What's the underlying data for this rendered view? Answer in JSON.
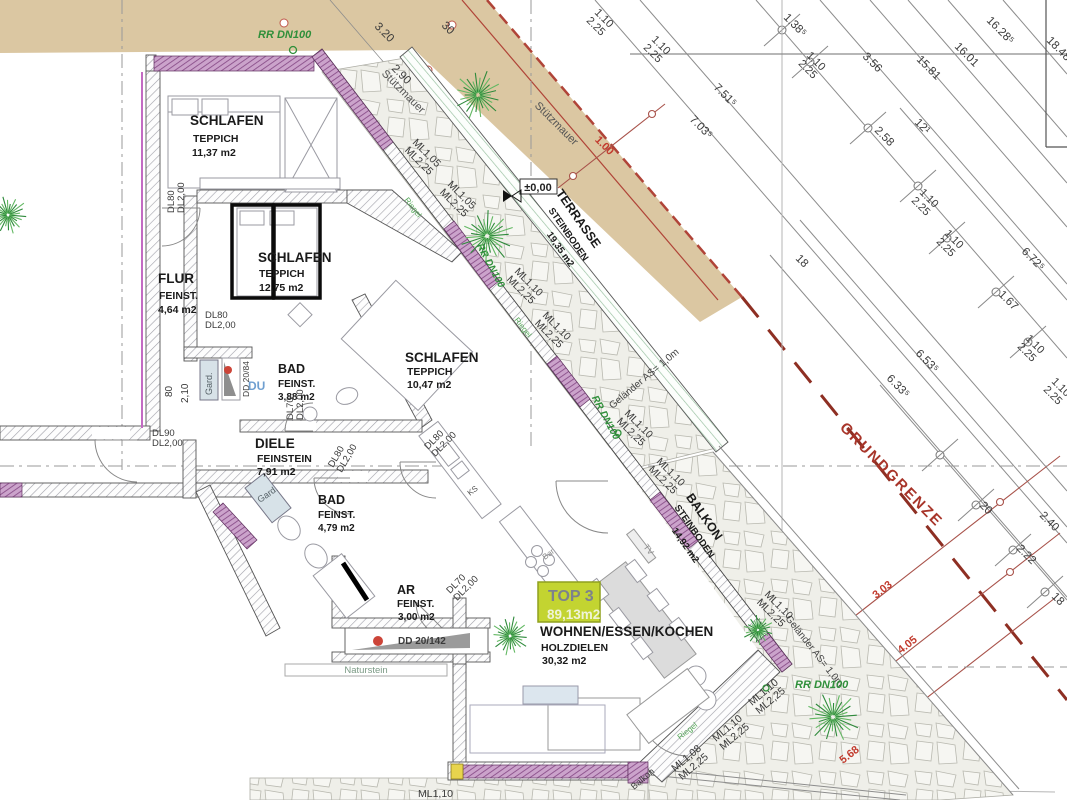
{
  "unit": {
    "name": "TOP 3",
    "area": "89,13m2"
  },
  "rooms": [
    {
      "name": "SCHLAFEN",
      "floor": "TEPPICH",
      "area": "11,37 m2"
    },
    {
      "name": "SCHLAFEN",
      "floor": "TEPPICH",
      "area": "12,75 m2"
    },
    {
      "name": "FLUR",
      "floor": "FEINST.",
      "area": "4,64 m2"
    },
    {
      "name": "BAD",
      "floor": "FEINST.",
      "area": "3,88 m2"
    },
    {
      "name": "DIELE",
      "floor": "FEINSTEIN",
      "area": "7,91 m2"
    },
    {
      "name": "BAD",
      "floor": "FEINST.",
      "area": "4,79 m2"
    },
    {
      "name": "AR",
      "floor": "FEINST.",
      "area": "3,00 m2"
    },
    {
      "name": "SCHLAFEN",
      "floor": "TEPPICH",
      "area": "10,47 m2"
    },
    {
      "name": "TERRASSE",
      "floor": "STEINBODEN",
      "area": "19,35 m2"
    },
    {
      "name": "BALKON",
      "floor": "STEINBODEN",
      "area": "14,92 m2"
    },
    {
      "name": "WOHNEN/ESSEN/KOCHEN",
      "floor": "HOLZDIELEN",
      "area": "30,32 m2"
    }
  ],
  "site": {
    "boundary_label": "GRUNDGRENZE",
    "retaining_wall_label": "Stützmauer",
    "railing_label": "Geländer AS= 1,0m",
    "level_label": "±0,00",
    "path_label": "Naturstein",
    "drain_label": "RR DN100",
    "offset_dim": "1.00"
  },
  "colors": {
    "dim": "#3a3a3a",
    "red": "#c23b2e",
    "boundary": "#a8352a",
    "green": "#2f8f3a",
    "green2": "#58a85c",
    "blue": "#6f9fd0",
    "gray": "#8a8a8a",
    "muted": "#555555",
    "cab": "#556066",
    "natur": "#7b9a85",
    "tan": "#dbc7a2",
    "purple": "#cba3cb",
    "top3_box": "#c3d431"
  },
  "annotations": [
    {
      "t": "3.20",
      "x": 374,
      "y": 27,
      "r": 45,
      "s": 11.5
    },
    {
      "t": "30",
      "x": 441,
      "y": 26,
      "r": 45,
      "s": 11.5
    },
    {
      "t": "2.90",
      "x": 391,
      "y": 69,
      "r": 45,
      "s": 11.5
    },
    {
      "t": "1.38⁵",
      "x": 783,
      "y": 18,
      "r": 45,
      "s": 11.5
    },
    {
      "t": "3.56",
      "x": 862,
      "y": 57,
      "r": 45,
      "s": 11.5
    },
    {
      "t": "15.81",
      "x": 916,
      "y": 60,
      "r": 45,
      "s": 11.5
    },
    {
      "t": "16.01",
      "x": 954,
      "y": 47,
      "r": 45,
      "s": 11.5
    },
    {
      "t": "16.28⁵",
      "x": 986,
      "y": 21,
      "r": 45,
      "s": 11.5
    },
    {
      "t": "18.48⁵",
      "x": 1046,
      "y": 41,
      "r": 45,
      "s": 11.5
    },
    {
      "t": "7.51⁵",
      "x": 713,
      "y": 88,
      "r": 45,
      "s": 11.5
    },
    {
      "t": "7.03⁵",
      "x": 689,
      "y": 120,
      "r": 45,
      "s": 11.5
    },
    {
      "t": "6.72⁵",
      "x": 1021,
      "y": 252,
      "r": 45,
      "s": 11.5
    },
    {
      "t": "6.53⁵",
      "x": 915,
      "y": 354,
      "r": 45,
      "s": 11.5
    },
    {
      "t": "6.33⁵",
      "x": 886,
      "y": 379,
      "r": 45,
      "s": 11.5
    },
    {
      "t": "2.58",
      "x": 874,
      "y": 131,
      "r": 45,
      "s": 11.5
    },
    {
      "t": "12¹",
      "x": 914,
      "y": 123,
      "r": 45,
      "s": 11.5
    },
    {
      "t": "1.67",
      "x": 998,
      "y": 295,
      "r": 45,
      "s": 11.5
    },
    {
      "t": "2.40",
      "x": 1039,
      "y": 516,
      "r": 45,
      "s": 11.5
    },
    {
      "t": "2.22",
      "x": 1016,
      "y": 549,
      "r": 45,
      "s": 11.5
    },
    {
      "t": "18",
      "x": 1051,
      "y": 597,
      "r": 45,
      "s": 11.5
    },
    {
      "t": "18",
      "x": 795,
      "y": 259,
      "r": 45,
      "s": 11.5
    },
    {
      "t": "20",
      "x": 979,
      "y": 506,
      "r": 45,
      "s": 11.5
    },
    {
      "t": "1.10",
      "t2": "2.25",
      "x": 806,
      "y": 56,
      "r": 45,
      "s": 11
    },
    {
      "t": "1.10",
      "t2": "2.25",
      "x": 919,
      "y": 193,
      "r": 45,
      "s": 11
    },
    {
      "t": "1.10",
      "t2": "2.25",
      "x": 944,
      "y": 234,
      "r": 45,
      "s": 11
    },
    {
      "t": "1.10",
      "t2": "2.25",
      "x": 1025,
      "y": 339,
      "r": 45,
      "s": 11
    },
    {
      "t": "1.10",
      "t2": "2.25",
      "x": 1051,
      "y": 382,
      "r": 45,
      "s": 11
    },
    {
      "t": "1.10",
      "t2": "2.25",
      "x": 594,
      "y": 13,
      "r": 45,
      "s": 11
    },
    {
      "t": "1.10",
      "t2": "2.25",
      "x": 651,
      "y": 40,
      "r": 45,
      "s": 11
    },
    {
      "t": "3.03",
      "x": 876,
      "y": 599,
      "r": -38,
      "s": 11,
      "c": "red",
      "w": "bold"
    },
    {
      "t": "4.05",
      "x": 901,
      "y": 654,
      "r": -38,
      "s": 11,
      "c": "red",
      "w": "bold"
    },
    {
      "t": "5.68",
      "x": 843,
      "y": 764,
      "r": -38,
      "s": 11,
      "c": "red",
      "w": "bold"
    },
    {
      "t": "ML1,05",
      "t2": "ML2,25",
      "x": 412,
      "y": 143,
      "r": 45,
      "s": 10.5
    },
    {
      "t": "ML1,05",
      "t2": "ML2,25",
      "x": 447,
      "y": 185,
      "r": 45,
      "s": 10.5
    },
    {
      "t": "ML1,10",
      "t2": "ML2,25",
      "x": 514,
      "y": 272,
      "r": 45,
      "s": 10.5
    },
    {
      "t": "ML1,10",
      "t2": "ML2,25",
      "x": 542,
      "y": 316,
      "r": 45,
      "s": 10.5
    },
    {
      "t": "ML1,10",
      "t2": "ML2,25",
      "x": 624,
      "y": 414,
      "r": 45,
      "s": 10.5
    },
    {
      "t": "ML1,10",
      "t2": "ML2,25",
      "x": 656,
      "y": 462,
      "r": 45,
      "s": 10.5
    },
    {
      "t": "ML1,10",
      "t2": "ML2,25",
      "x": 764,
      "y": 595,
      "r": 45,
      "s": 10.5
    },
    {
      "t": "ML1,10",
      "t2": "ML2,25",
      "x": 752,
      "y": 706,
      "r": -40,
      "s": 10.5
    },
    {
      "t": "ML1,10",
      "t2": "ML2,25",
      "x": 716,
      "y": 742,
      "r": -40,
      "s": 10.5
    },
    {
      "t": "ML1,08",
      "t2": "ML2,25",
      "x": 675,
      "y": 772,
      "r": -40,
      "s": 10.5
    },
    {
      "t": "ML1,10",
      "x": 418,
      "y": 797,
      "r": 0,
      "s": 10.5
    },
    {
      "t": "DL80",
      "t2": "DL2,00",
      "x": 174,
      "y": 213,
      "r": -90,
      "s": 9.5
    },
    {
      "t": "DL80",
      "t2": "DL2,00",
      "x": 205,
      "y": 318,
      "r": 0,
      "s": 9.5
    },
    {
      "t": "DL90",
      "t2": "DL2,00",
      "x": 152,
      "y": 436,
      "r": 0,
      "s": 9.5
    },
    {
      "t": "DL70",
      "t2": "DL2,00",
      "x": 293,
      "y": 420,
      "r": -90,
      "s": 9.5
    },
    {
      "t": "DL80",
      "t2": "DL2,00",
      "x": 333,
      "y": 468,
      "r": -60,
      "s": 9.5
    },
    {
      "t": "DL80",
      "t2": "DL2,00",
      "x": 428,
      "y": 450,
      "r": -45,
      "s": 9.5
    },
    {
      "t": "DL70",
      "t2": "DL2,00",
      "x": 450,
      "y": 594,
      "r": -45,
      "s": 9.5
    },
    {
      "t": "DD 20/84",
      "x": 249,
      "y": 397,
      "r": -90,
      "s": 8.5
    },
    {
      "t": "DD 20/142",
      "x": 398,
      "y": 644,
      "r": 0,
      "s": 10,
      "w": "bold"
    },
    {
      "t": "DU",
      "x": 248,
      "y": 390,
      "r": 0,
      "s": 12,
      "c": "blue",
      "w": "bold"
    },
    {
      "t": "Gard.",
      "x": 212,
      "y": 395,
      "r": -90,
      "s": 9,
      "c": "cab"
    },
    {
      "t": "Gard.",
      "x": 260,
      "y": 503,
      "r": -35,
      "s": 9,
      "c": "cab"
    },
    {
      "t": "KS",
      "x": 470,
      "y": 496,
      "r": -38,
      "s": 8,
      "c": "muted"
    },
    {
      "t": "Bar",
      "x": 545,
      "y": 560,
      "r": -38,
      "s": 8,
      "c": "gray"
    },
    {
      "t": "TV",
      "x": 643,
      "y": 547,
      "r": 52,
      "s": 8.5,
      "c": "gray"
    },
    {
      "t": "80",
      "x": 172,
      "y": 397,
      "r": -90,
      "s": 10
    },
    {
      "t": "2,10",
      "x": 188,
      "y": 403,
      "r": -90,
      "s": 10
    },
    {
      "t": "Balkon",
      "x": 634,
      "y": 790,
      "r": -40,
      "s": 9
    },
    {
      "t": "Riegel",
      "x": 404,
      "y": 200,
      "r": 52,
      "s": 8,
      "c": "green2"
    },
    {
      "t": "Riegel",
      "x": 514,
      "y": 320,
      "r": 52,
      "s": 8,
      "c": "green2"
    },
    {
      "t": "Riegel",
      "x": 680,
      "y": 740,
      "r": -38,
      "s": 8,
      "c": "green2"
    }
  ],
  "trees": [
    {
      "x": 478,
      "y": 95,
      "r": 26
    },
    {
      "x": 487,
      "y": 236,
      "r": 28
    },
    {
      "x": 510,
      "y": 636,
      "r": 20
    },
    {
      "x": 758,
      "y": 630,
      "r": 16
    },
    {
      "x": 833,
      "y": 717,
      "r": 28
    },
    {
      "x": 8,
      "y": 215,
      "r": 20
    }
  ]
}
